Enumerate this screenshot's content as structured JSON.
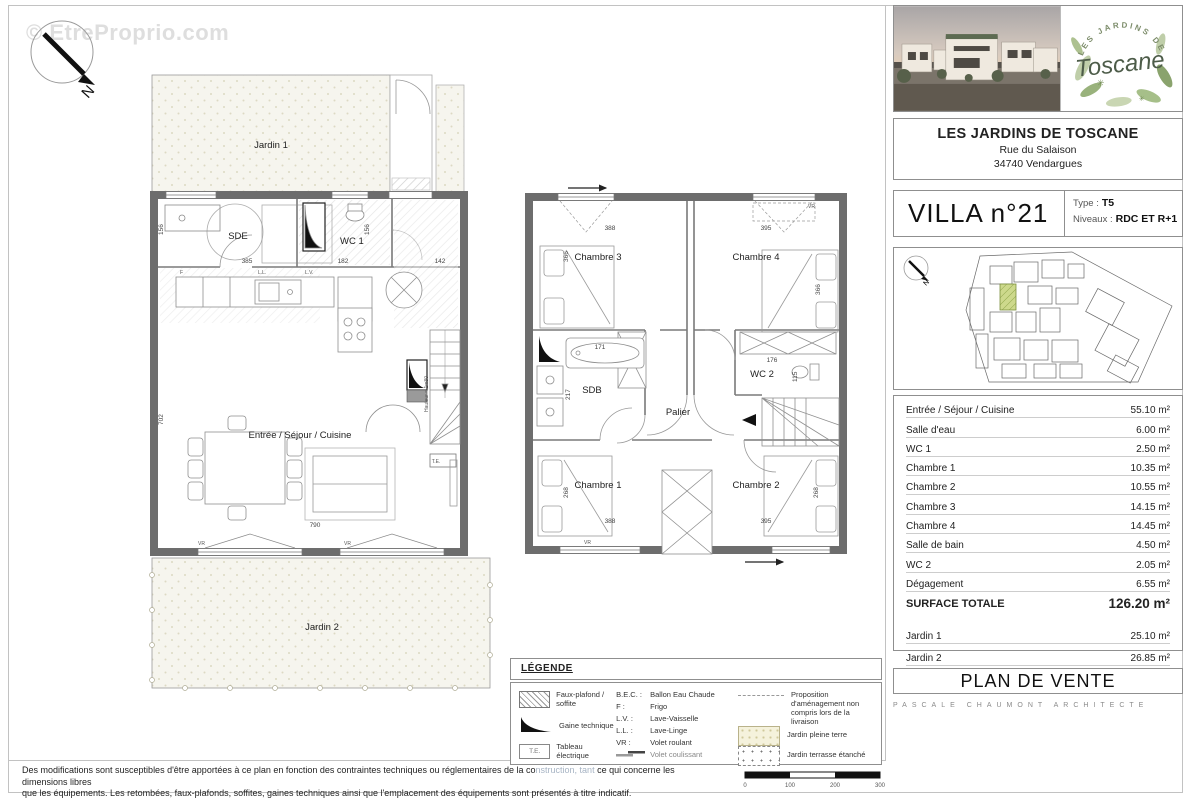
{
  "watermark": "© EtreProprio.com",
  "compass": {
    "n": "N"
  },
  "project": {
    "name": "LES JARDINS DE TOSCANE",
    "address_line1": "Rue du Salaison",
    "address_line2": "34740 Vendargues",
    "logo_arc": "LES JARDINS DE",
    "logo_script": "Toscane"
  },
  "villa": {
    "title": "VILLA n°21",
    "type_label": "Type :",
    "type_value": "T5",
    "niveaux_label": "Niveaux :",
    "niveaux_value": "RDC ET R+1"
  },
  "areas": {
    "rows": [
      {
        "label": "Entrée / Séjour / Cuisine",
        "value": "55.10 m²"
      },
      {
        "label": "Salle d'eau",
        "value": "6.00 m²"
      },
      {
        "label": "WC 1",
        "value": "2.50 m²"
      },
      {
        "label": "Chambre 1",
        "value": "10.35 m²"
      },
      {
        "label": "Chambre 2",
        "value": "10.55 m²"
      },
      {
        "label": "Chambre 3",
        "value": "14.15 m²"
      },
      {
        "label": "Chambre 4",
        "value": "14.45 m²"
      },
      {
        "label": "Salle de bain",
        "value": "4.50 m²"
      },
      {
        "label": "WC 2",
        "value": "2.05 m²"
      },
      {
        "label": "Dégagement",
        "value": "6.55 m²"
      }
    ],
    "total_label": "SURFACE TOTALE",
    "total_value": "126.20 m²",
    "jardin_rows": [
      {
        "label": "Jardin 1",
        "value": "25.10 m²"
      },
      {
        "label": "Jardin 2",
        "value": "26.85 m²"
      }
    ]
  },
  "footer": {
    "plan_title": "PLAN DE VENTE",
    "architect": "PASCALE CHAUMONT ARCHITECTE"
  },
  "legend": {
    "title": "LÉGENDE",
    "col1": [
      {
        "label": "Faux-plafond / soffite"
      },
      {
        "label": "Gaine technique"
      },
      {
        "label": "Tableau électrique",
        "icon_text": "T.E."
      }
    ],
    "col2": [
      {
        "key": "B.E.C. :",
        "label": "Ballon Eau Chaude"
      },
      {
        "key": "F :",
        "label": "Frigo"
      },
      {
        "key": "L.V. :",
        "label": "Lave-Vaisselle"
      },
      {
        "key": "L.L. :",
        "label": "Lave-Linge"
      },
      {
        "key": "VR :",
        "label": "Volet roulant"
      },
      {
        "key": "",
        "label": "Volet coulissant"
      }
    ],
    "col3": [
      {
        "label": "Proposition d'aménagement non compris lors de la livraison"
      },
      {
        "label": "Jardin pleine terre"
      },
      {
        "label": "Jardin terrasse étanché"
      }
    ]
  },
  "disclaimer": {
    "line1_a": "Des modifications sont susceptibles d'être apportées à ce plan en fonction des contraintes techniques ou réglementaires de la co",
    "line1_b": "nstruction, tant",
    "line1_c": " ce qui concerne les dimensions libres",
    "line2": "que les équipements. Les retombées, faux-plafonds, soffites, gaines techniques ainsi que l'emplacement des équipements sont présentés à titre indicatif."
  },
  "scalebar": {
    "ticks": [
      "0",
      "100",
      "200",
      "300"
    ]
  },
  "rdc": {
    "jardin1": "Jardin 1",
    "jardin2": "Jardin 2",
    "sde": "SDE",
    "wc1": "WC 1",
    "sejour": "Entrée / Séjour / Cuisine",
    "te": "T.E.",
    "hauteur": "Hauteur = 1m80",
    "vr": "VR",
    "f": "F",
    "ll": "L.L.",
    "lv": "L.V.",
    "dims": {
      "sde_w": "385",
      "sde_h": "156",
      "wc1_w": "182",
      "wc1_h": "156",
      "entry_w": "142",
      "room_h": "702",
      "room_w": "790"
    }
  },
  "r1": {
    "ch1": "Chambre 1",
    "ch2": "Chambre 2",
    "ch3": "Chambre 3",
    "ch4": "Chambre 4",
    "sdb": "SDB",
    "wc2": "WC 2",
    "palier": "Palier",
    "vr": "VR",
    "dims": {
      "ch3_w": "388",
      "ch4_w": "395",
      "ch3_h": "366",
      "ch4_h": "366",
      "bath_w": "171",
      "sdb_h": "217",
      "wc2_w": "176",
      "wc2_h": "115",
      "ch1_h": "268",
      "ch2_h": "268",
      "ch1_w": "388",
      "ch2_w": "395"
    }
  }
}
